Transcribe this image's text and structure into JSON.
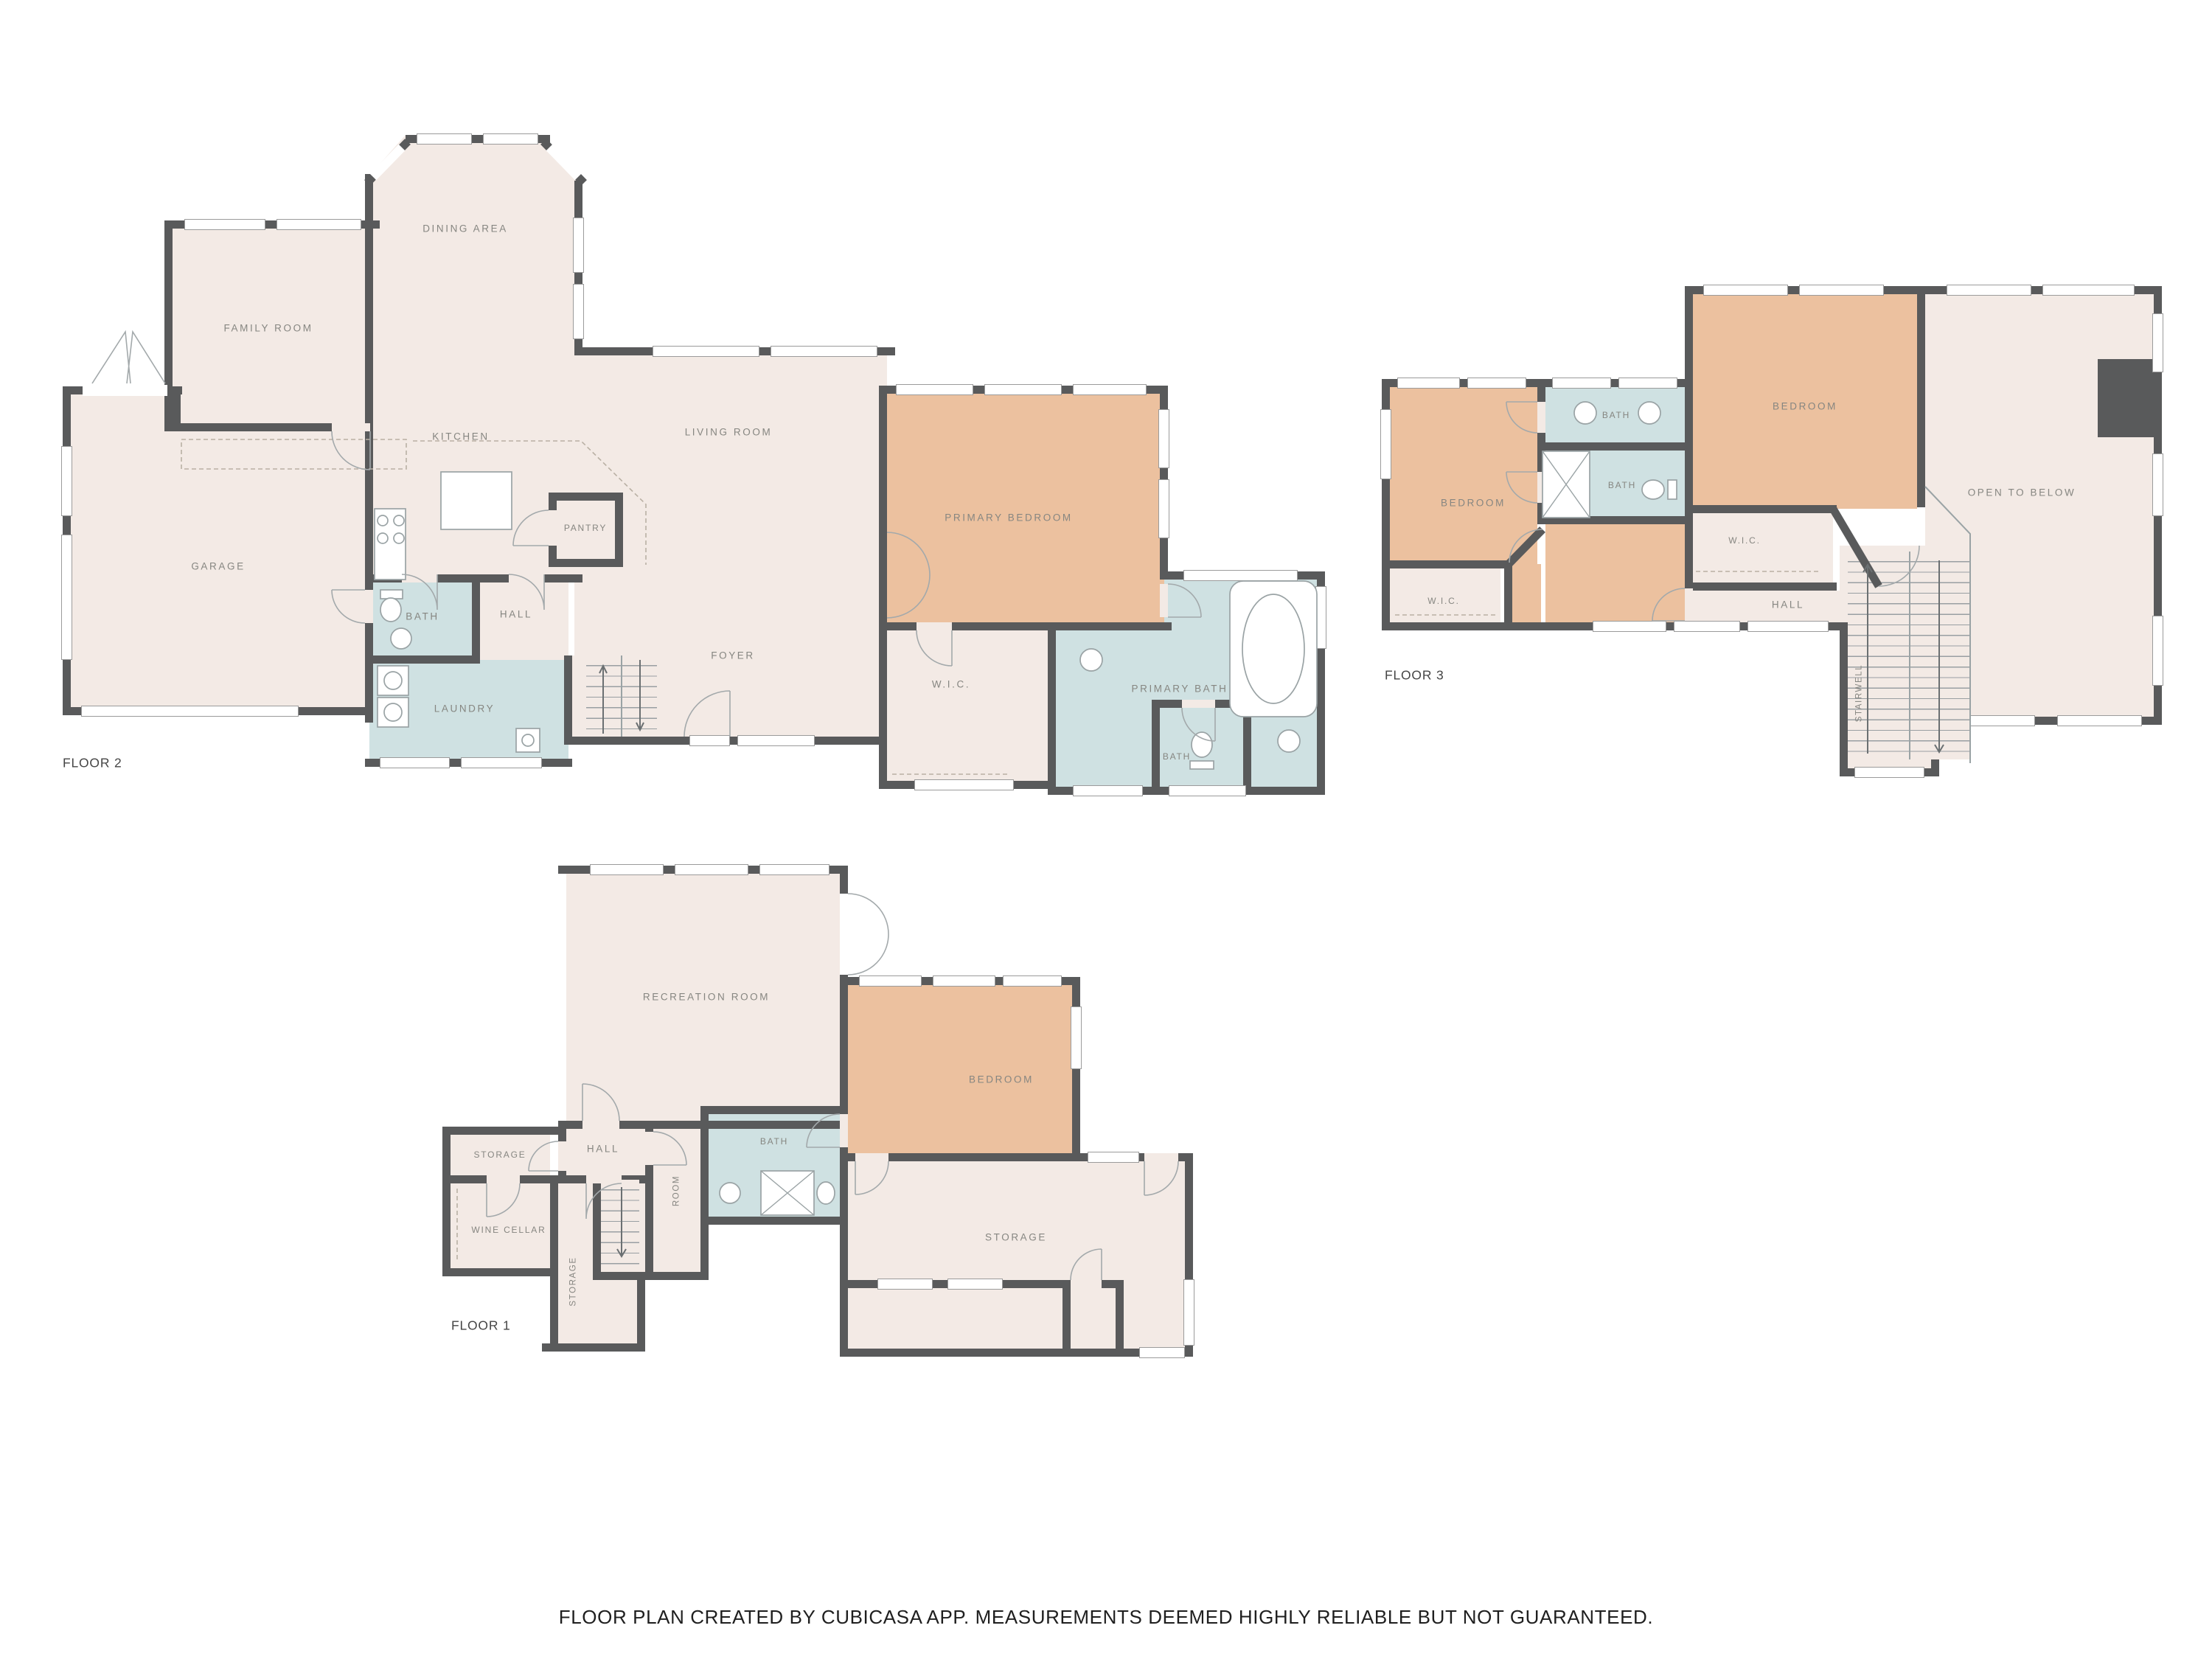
{
  "colors": {
    "wall": "#595a5b",
    "cream": "#f3eae5",
    "tan": "#ecc19f",
    "blu": "#cfe1e2",
    "lbl": "#868681"
  },
  "floor2": {
    "label": "FLOOR 2",
    "rooms": {
      "dining": "DINING AREA",
      "family": "FAMILY ROOM",
      "kitchen": "KITCHEN",
      "living": "LIVING ROOM",
      "garage": "GARAGE",
      "pantry": "PANTRY",
      "bath": "BATH",
      "hall": "HALL",
      "laundry": "LAUNDRY",
      "foyer": "FOYER",
      "primary_bedroom": "PRIMARY BEDROOM",
      "wic": "W.I.C.",
      "primary_bath": "PRIMARY BATH",
      "bath_small": "BATH"
    }
  },
  "floor3": {
    "label": "FLOOR 3",
    "rooms": {
      "bedroom_left": "BEDROOM",
      "bath_top": "BATH",
      "bath_mid": "BATH",
      "bedroom_right": "BEDROOM",
      "wic_right": "W.I.C.",
      "wic_left": "W.I.C.",
      "hall": "HALL",
      "open_to_below": "OPEN TO BELOW",
      "stairwell": "STAIRWELL"
    }
  },
  "floor1": {
    "label": "FLOOR 1",
    "rooms": {
      "recreation": "RECREATION ROOM",
      "bedroom": "BEDROOM",
      "storage_small": "STORAGE",
      "hall": "HALL",
      "wine_cellar": "WINE CELLAR",
      "storage_strip": "STORAGE",
      "room": "ROOM",
      "bath": "BATH",
      "storage_big": "STORAGE"
    }
  },
  "footer": {
    "text": "FLOOR PLAN CREATED BY CUBICASA APP. MEASUREMENTS DEEMED HIGHLY RELIABLE BUT NOT GUARANTEED."
  }
}
